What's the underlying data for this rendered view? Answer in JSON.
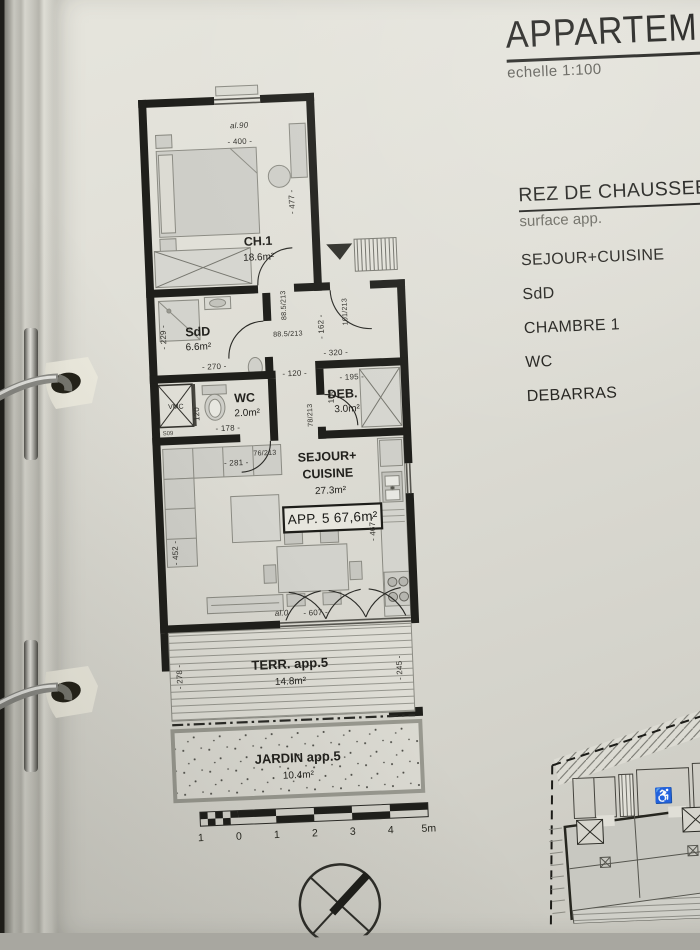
{
  "page": {
    "title": "APPARTEM",
    "scale_note": "echelle 1:100",
    "legend": {
      "heading": "REZ DE CHAUSSEE",
      "subheading": "surface app.",
      "items": [
        "SEJOUR+CUISINE",
        "SdD",
        "CHAMBRE 1",
        "WC",
        "DEBARRAS"
      ]
    }
  },
  "plan": {
    "rooms": {
      "ch1": {
        "name": "CH.1",
        "area": "18.6m²"
      },
      "sdd": {
        "name": "SdD",
        "area": "6.6m²"
      },
      "wc": {
        "name": "WC",
        "area": "2.0m²"
      },
      "deb": {
        "name": "DEB.",
        "area": "3.0m²"
      },
      "sejour": {
        "name_line1": "SEJOUR+",
        "name_line2": "CUISINE",
        "area": "27.3m²"
      },
      "terrace": {
        "name": "TERR. app.5",
        "area": "14.8m²"
      },
      "garden": {
        "name": "JARDIN app.5",
        "area": "10.4m²"
      }
    },
    "apartment_badge": "APP. 5  67,6m²",
    "shaft_label": "VMC",
    "shaft_sublabel": "S09",
    "dims": [
      {
        "t": "al.90",
        "x": 112,
        "y": 46,
        "r": 0,
        "c": "it",
        "n": "window-sill-label-ch1"
      },
      {
        "t": "- 400 -",
        "x": 112,
        "y": 62,
        "r": 0,
        "n": "dim-ch1-width"
      },
      {
        "t": "- 477 -",
        "x": 164,
        "y": 122,
        "r": -90,
        "n": "dim-ch1-height"
      },
      {
        "t": "88.5/213",
        "x": 151,
        "y": 225,
        "r": -90,
        "c": "door",
        "n": "door-size-ch1"
      },
      {
        "t": "101/213",
        "x": 212,
        "y": 234,
        "r": -90,
        "c": "door",
        "n": "door-size-entrance"
      },
      {
        "t": "- 162 -",
        "x": 188,
        "y": 248,
        "r": -90,
        "n": "dim-hall-depth"
      },
      {
        "t": "- 320 -",
        "x": 199,
        "y": 277,
        "r": 0,
        "n": "dim-hall-width"
      },
      {
        "t": "- 229 -",
        "x": 30,
        "y": 252,
        "r": -90,
        "n": "dim-sdd-height"
      },
      {
        "t": "- 270 -",
        "x": 77,
        "y": 286,
        "r": 0,
        "n": "dim-sdd-width"
      },
      {
        "t": "88.5/213",
        "x": 152,
        "y": 256,
        "r": 0,
        "c": "door",
        "n": "door-size-sdd"
      },
      {
        "t": "120",
        "x": 60,
        "y": 330,
        "r": -90,
        "n": "dim-wc-height"
      },
      {
        "t": "- 178 -",
        "x": 88,
        "y": 348,
        "r": 0,
        "n": "dim-wc-width"
      },
      {
        "t": "76/213",
        "x": 124,
        "y": 374,
        "r": 0,
        "c": "door",
        "n": "door-size-wc"
      },
      {
        "t": "- 195 -",
        "x": 214,
        "y": 302,
        "r": 0,
        "n": "dim-deb-width"
      },
      {
        "t": "166",
        "x": 195,
        "y": 318,
        "r": -90,
        "n": "dim-deb-height"
      },
      {
        "t": "78/213",
        "x": 173,
        "y": 336,
        "r": -90,
        "c": "door",
        "n": "door-size-deb"
      },
      {
        "t": "- 120 -",
        "x": 157,
        "y": 296,
        "r": 0,
        "n": "dim-corridor-width"
      },
      {
        "t": "- 281 -",
        "x": 95,
        "y": 383,
        "r": 0,
        "n": "dim-sofa"
      },
      {
        "t": "- 452 -",
        "x": 33,
        "y": 468,
        "r": -90,
        "n": "dim-sejour-left"
      },
      {
        "t": "- 467 -",
        "x": 231,
        "y": 452,
        "r": -90,
        "n": "dim-kitchen-side"
      },
      {
        "t": "- 607 -",
        "x": 168,
        "y": 536,
        "r": 0,
        "n": "dim-sejour-width"
      },
      {
        "t": "al.0",
        "x": 134,
        "y": 535,
        "r": 0,
        "c": "it",
        "n": "window-sill-label-sejour"
      },
      {
        "t": "- 278 -",
        "x": 32,
        "y": 592,
        "r": -90,
        "n": "dim-terrace-left"
      },
      {
        "t": "- 245 -",
        "x": 252,
        "y": 592,
        "r": -90,
        "n": "dim-terrace-right"
      }
    ]
  },
  "scalebar": {
    "labels": [
      "1",
      "0",
      "1",
      "2",
      "3",
      "4",
      "5m"
    ]
  },
  "siteplan": {
    "accessible_parking_icon": "♿"
  }
}
